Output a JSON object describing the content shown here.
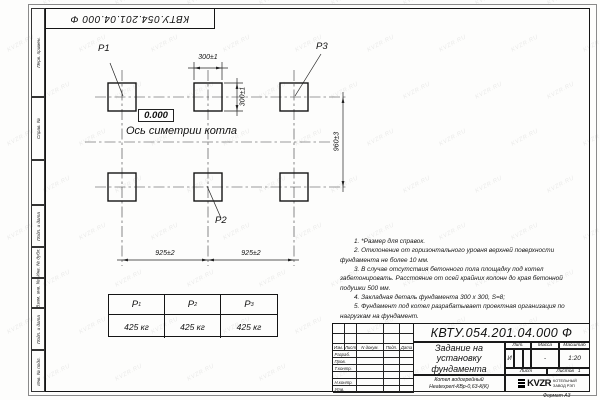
{
  "watermark": {
    "text": "KVZR.RU"
  },
  "top_stamp": {
    "number": "КВТУ.054.201.04.000 Ф"
  },
  "side_stamp": {
    "items": [
      "Перв. примен.",
      "Справ. №",
      "",
      "Подп. и дата",
      "Инв. № дубл.",
      "Взам. инв. №",
      "Подп. и дата",
      "Инв. № подл."
    ]
  },
  "drawing": {
    "labels": {
      "p1": "P1",
      "p2": "P2",
      "p3": "P3",
      "elevation": "0.000",
      "axis": "Ось симетрии котла"
    },
    "dimensions": {
      "width_top": "300±1",
      "height_small": "300±1",
      "height_right": "960±3",
      "span_left": "925±2",
      "span_right": "925±2"
    }
  },
  "notes": [
    "1. *Размер для справок.",
    "2. Отклонение от горизонтального уровня верхней поверхности фундамента не более 10 мм.",
    "3. В случае отсутствия бетонного пола площадку под котел забетонировать. Расстояние от осей крайних колонн до края бетонной подушки 500 мм.",
    "4. Закладная деталь фундамента 300 x 300, S=8;",
    "5. Фундамент под котел разрабатывает проектная организация по нагрузкам на фундамент."
  ],
  "load_table": {
    "columns": [
      {
        "label": "P",
        "sub": "1",
        "value": "425 кг"
      },
      {
        "label": "P",
        "sub": "2",
        "value": "425 кг"
      },
      {
        "label": "P",
        "sub": "3",
        "value": "425 кг"
      }
    ]
  },
  "title_block": {
    "designation": "КВТУ.054.201.04.000 Ф",
    "title_lines": [
      "Задание на",
      "установку",
      "фундамента"
    ],
    "product_lines": [
      "Котел водогрейный",
      "Heatexpert-КВр-0,63-К(К)"
    ],
    "header_cols": [
      "Изм.",
      "Лист",
      "N докум.",
      "Подп.",
      "Дата"
    ],
    "rows": [
      "Разраб.",
      "Пров.",
      "Т.контр.",
      "",
      "Н.контр.",
      "Утв."
    ],
    "lit_header": "Лит.",
    "lit_value": "И",
    "mass_header": "Масса",
    "mass_value": "-",
    "scale_header": "Масштаб",
    "scale_value": "1:20",
    "sheet_label": "Лист",
    "sheets_label": "Листов",
    "sheets_value": "1",
    "logo_text": "KVZR",
    "org_lines": [
      "КОТЕЛЬНЫЙ",
      "ЗАВОД РЭП"
    ],
    "format_label": "Формат А3"
  }
}
